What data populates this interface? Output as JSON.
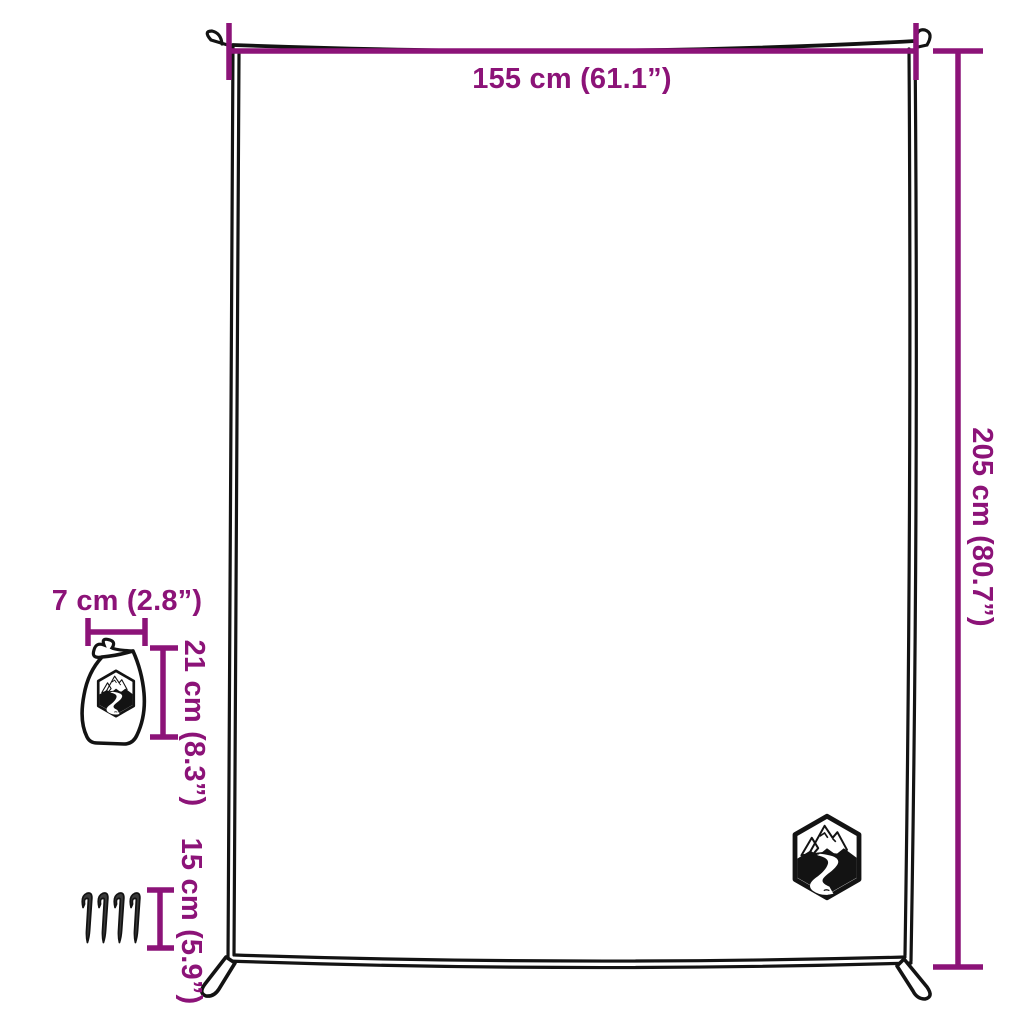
{
  "page": {
    "kind": "product-dimension-diagram",
    "background": "#ffffff"
  },
  "colors": {
    "accent": "#8C1378",
    "line": "#131313"
  },
  "labels": {
    "blanket_width": "155 cm (61.1”)",
    "blanket_height": "205 cm (80.7”)",
    "bag_width": "7 cm (2.8”)",
    "bag_height": "21 cm (8.3”)",
    "peg_length": "15 cm (5.9”)"
  },
  "objects": {
    "blanket": "blanket-outline-with-corner-loops",
    "storage_bag": "drawstring-bag-with-logo",
    "pegs_count": 4,
    "brand_logo": "mountain-river-hexagon-logo"
  }
}
